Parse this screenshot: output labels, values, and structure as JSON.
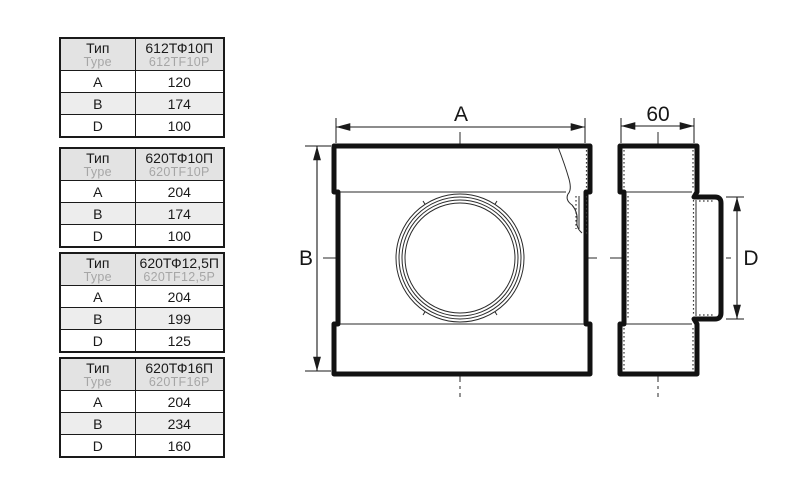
{
  "page": {
    "background": "#ffffff"
  },
  "colors": {
    "ink": "#1a1a1a",
    "gray_text": "#a6a6a6",
    "table_header_bg": "#e3e3e3",
    "table_alt_row_bg": "#ededed",
    "line": "#2a2a2a"
  },
  "tables": [
    {
      "header": {
        "type_ru": "Тип",
        "type_en": "Type",
        "model_ru": "612ТФ10П",
        "model_en": "612TF10P"
      },
      "rows": [
        {
          "param": "A",
          "value": "120"
        },
        {
          "param": "B",
          "value": "174"
        },
        {
          "param": "D",
          "value": "100"
        }
      ]
    },
    {
      "header": {
        "type_ru": "Тип",
        "type_en": "Type",
        "model_ru": "620ТФ10П",
        "model_en": "620TF10P"
      },
      "rows": [
        {
          "param": "A",
          "value": "204"
        },
        {
          "param": "B",
          "value": "174"
        },
        {
          "param": "D",
          "value": "100"
        }
      ]
    },
    {
      "header": {
        "type_ru": "Тип",
        "type_en": "Type",
        "model_ru": "620ТФ12,5П",
        "model_en": "620TF12,5P"
      },
      "rows": [
        {
          "param": "A",
          "value": "204"
        },
        {
          "param": "B",
          "value": "199"
        },
        {
          "param": "D",
          "value": "125"
        }
      ]
    },
    {
      "header": {
        "type_ru": "Тип",
        "type_en": "Type",
        "model_ru": "620ТФ16П",
        "model_en": "620TF16P"
      },
      "rows": [
        {
          "param": "A",
          "value": "204"
        },
        {
          "param": "B",
          "value": "234"
        },
        {
          "param": "D",
          "value": "160"
        }
      ]
    }
  ],
  "drawing": {
    "front_view": {
      "width_dim_label": "A",
      "height_dim_label": "B"
    },
    "side_view": {
      "depth_dim_label": "60",
      "spigot_dim_label": "D"
    }
  }
}
